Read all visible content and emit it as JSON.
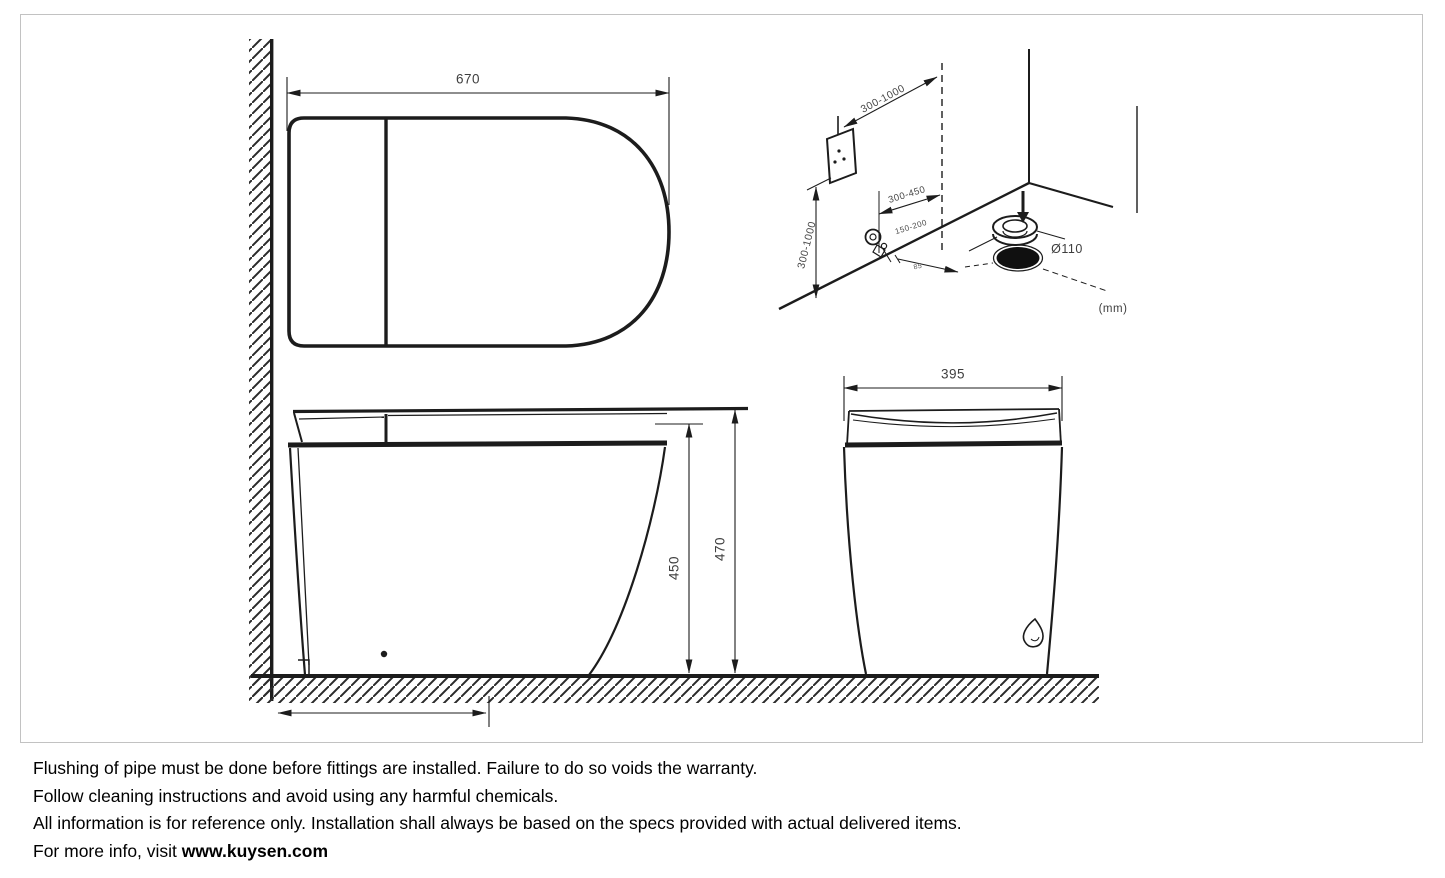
{
  "diagram": {
    "top_view": {
      "width": "670"
    },
    "side_view": {
      "seat_height": "450",
      "overall_height": "470"
    },
    "front_view": {
      "width": "395"
    },
    "installation": {
      "outlet_distance": "300-1000",
      "outlet_height": "300-1000",
      "valve_distance": "300-450",
      "valve_height": "150-200",
      "valve_offset": "85",
      "drain_diameter": "Ø110",
      "unit": "(mm)"
    }
  },
  "footer": {
    "line1": "Flushing of pipe must be done before fittings are installed. Failure to do so voids the warranty.",
    "line2": "Follow cleaning instructions and avoid using any harmful chemicals.",
    "line3": "All information is for reference only. Installation shall always be based on the specs provided with actual delivered items.",
    "line4_prefix": "For more info, visit ",
    "line4_link": "www.kuysen.com"
  }
}
